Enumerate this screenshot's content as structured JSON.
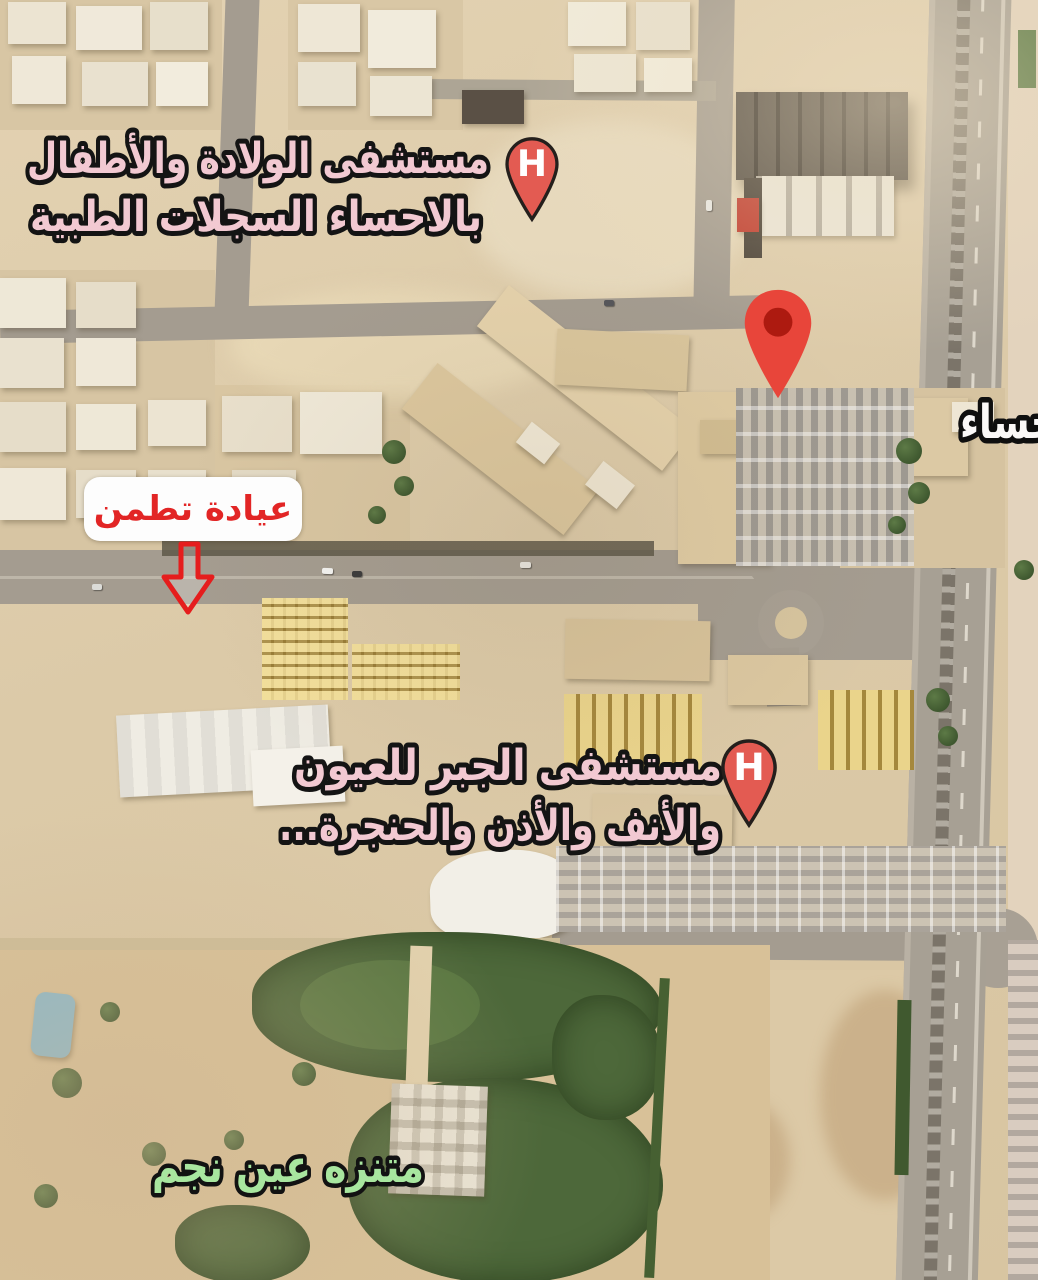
{
  "map_type": "satellite-annotated",
  "labels": {
    "hospital_top": {
      "line1": "مستشفى الولادة والأطفال",
      "line2": "بالاحساء السجلات الطبية",
      "color": "#f2c9d2"
    },
    "hospital_right": {
      "line1": "شفى الولادة",
      "line2": "ال بمحافظة",
      "line3": "الأحساء",
      "color": "#fbf9f8",
      "note_clipped_at_right_edge": true
    },
    "clinic": {
      "text": "عيادة تطمن",
      "color": "#e22525"
    },
    "hospital_jabr": {
      "line1": "مستشفى الجبر للعيون",
      "line2": "والأنف والأذن والحنجرة...",
      "color": "#f2c9d2"
    },
    "park": {
      "text": "متنزه عين نجم",
      "color": "#a8e69f"
    }
  },
  "markers": {
    "hospital_letter": "H",
    "hospital_pin_color": "#e35b52",
    "place_pin_color": "#e8453a",
    "place_pin_inner_color": "#ad1a10",
    "arrow_color": "#e51d1d"
  },
  "colors": {
    "sand": "#dccaa8",
    "road": "#a49c90",
    "highway_median": "#7b7469",
    "building_light": "#efe8d8",
    "building_dark": "#473f35",
    "market_yellow": "#caa94e",
    "vegetation": "#4d683a",
    "pool": "#8cb9ca"
  }
}
